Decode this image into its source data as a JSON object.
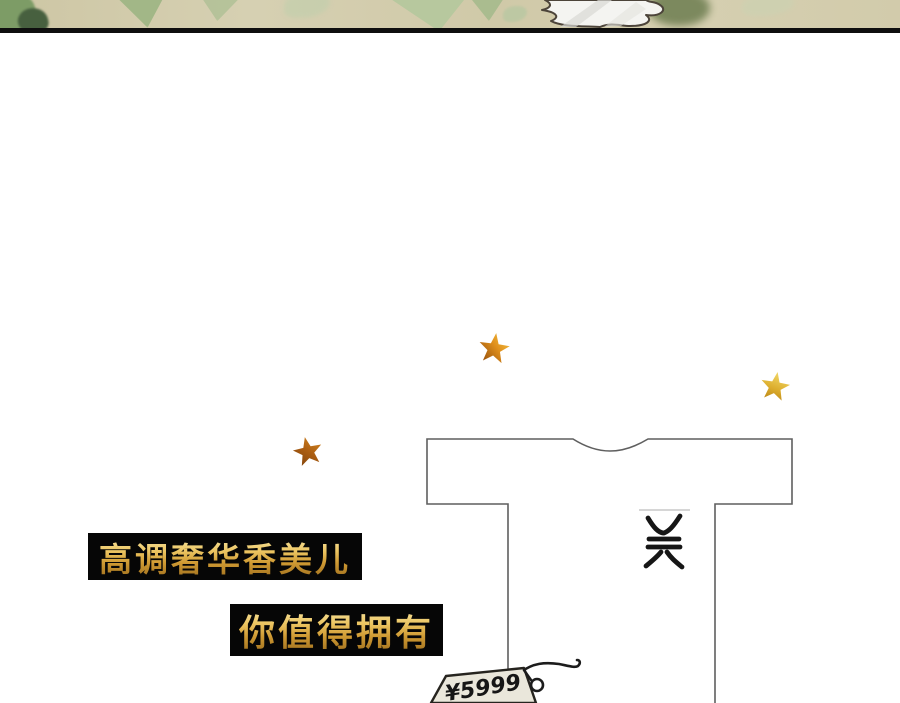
{
  "canvas": {
    "width": 900,
    "height": 703,
    "background": "#ffffff"
  },
  "header_art": {
    "description": "watercolor leaf banner with white crumpled paper",
    "background_color": "#d2cbab",
    "divider_color": "#0e0e0e",
    "leaf_green": "#9db583",
    "dark_leaf_green": "#47603f",
    "paper_white": "#f4f4f1"
  },
  "slogans": {
    "line1": "高调奢华香美儿",
    "line2": "你值得拥有",
    "banner_background": "#060606",
    "gold_color": "#dcaa48"
  },
  "shirt": {
    "outline_color": "#5f5f5f",
    "fill_color": "#ffffff",
    "logo": "brand-monogram"
  },
  "price_tag": {
    "text": "¥5999",
    "fill_color": "#eae7db",
    "ink_color": "#1c1c1c"
  },
  "stars": {
    "count": 3,
    "gold": "#f2d96a",
    "amber": "#e0901d",
    "brown": "#8a4a0e"
  }
}
